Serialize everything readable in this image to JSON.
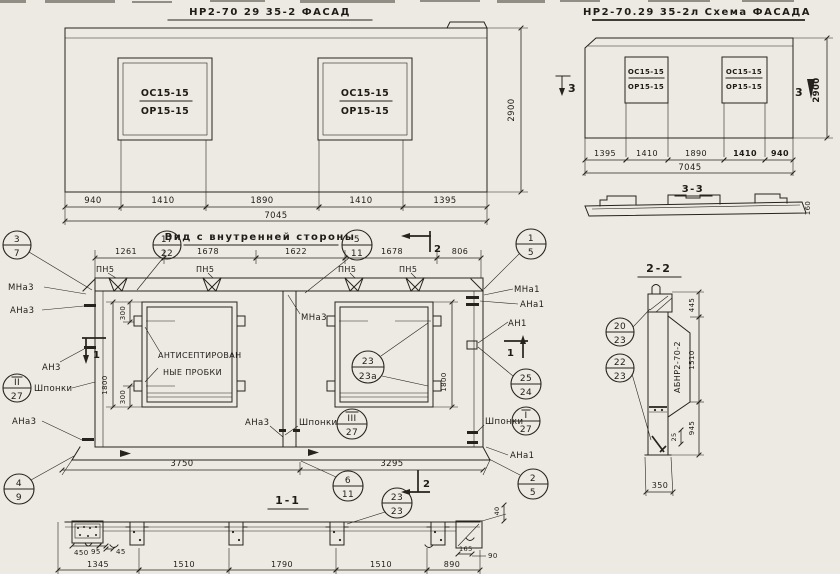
{
  "drawing": {
    "facade": {
      "title": "НР2-70 29 35-2   ФАСАД",
      "win_top": "ОС15-15",
      "win_bot": "ОР15-15",
      "dims": [
        "940",
        "1410",
        "1890",
        "1410",
        "1395"
      ],
      "total": "7045",
      "height": "2900"
    },
    "schema": {
      "title": "НР2-70.29 35-2л  Схема ФАСАДА",
      "mark": "3",
      "dims": [
        "1395",
        "1410",
        "1890",
        "1410",
        "940"
      ],
      "total": "7045",
      "height": "2900",
      "sec33_title": "3-3",
      "sec33_thk": "160"
    },
    "inner": {
      "title": "Вид с внутренней стороны",
      "dims_top": [
        "1261",
        "1678",
        "1622",
        "1678",
        "806"
      ],
      "pn5": "ПН5",
      "note1": "АНТИСЕПТИРОВАН",
      "note2": "НЫЕ ПРОБКИ",
      "keys": "Шпонки",
      "mna3": "МНа3",
      "ana3": "АНа3",
      "an3": "АН3",
      "mna1": "МНа1",
      "ana1": "АНа1",
      "an1": "АН1",
      "d300": "300",
      "d1800": "1800",
      "d3750": "3750",
      "d3295": "3295",
      "sec1": "1",
      "sec2": "2"
    },
    "sec22": {
      "title": "2-2",
      "mark": "АБНР2-70-2",
      "d445": "445",
      "d1510": "1510",
      "d945": "945",
      "d25": "25",
      "d350": "350"
    },
    "sec11": {
      "title": "1-1",
      "d450": "450",
      "d95": "95",
      "d45": "45",
      "dims": [
        "1345",
        "1510",
        "1790",
        "1510",
        "890"
      ],
      "d165": "165",
      "d90": "90",
      "d40": "40"
    },
    "balloons": {
      "b3_7": [
        "3",
        "7"
      ],
      "b17_22": [
        "17",
        "22"
      ],
      "b5_11": [
        "5",
        "11"
      ],
      "b1_5": [
        "1",
        "5"
      ],
      "b4_9": [
        "4",
        "9"
      ],
      "b6_11": [
        "6",
        "11"
      ],
      "b2_5": [
        "2",
        "5"
      ],
      "b23_23a": [
        "23",
        "23а"
      ],
      "b25_24": [
        "25",
        "24"
      ],
      "b20_23": [
        "20",
        "23"
      ],
      "b22_23": [
        "22",
        "23"
      ],
      "b23_23": [
        "23",
        "23"
      ],
      "bI_27": [
        "I",
        "27"
      ],
      "bII_27": [
        "II",
        "27"
      ],
      "bIII_27": [
        "III",
        "27"
      ]
    }
  }
}
